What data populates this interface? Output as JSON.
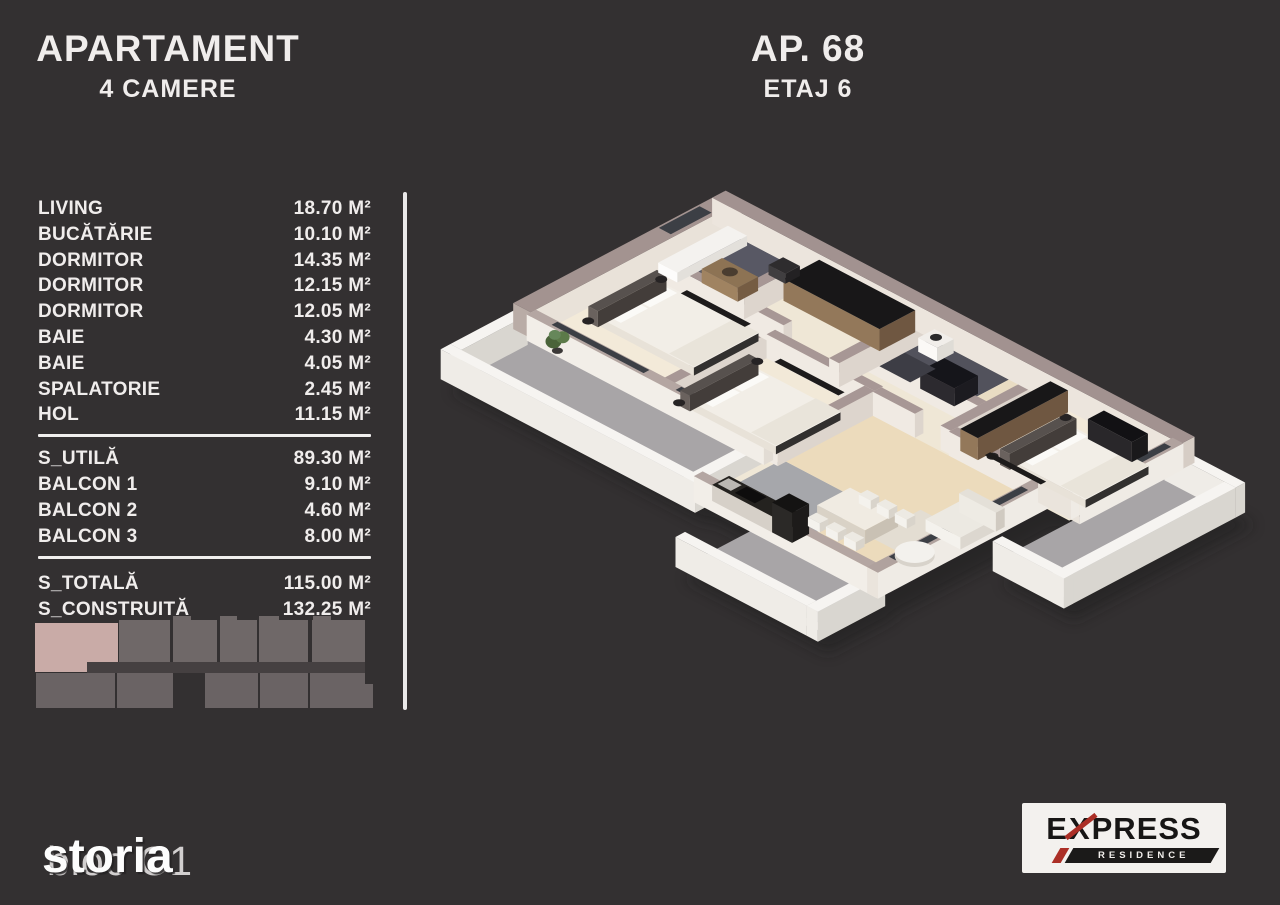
{
  "header_left": {
    "title": "APARTAMENT",
    "subtitle": "4 CAMERE"
  },
  "header_right": {
    "apartment": "AP. 68",
    "floor": "ETAJ 6"
  },
  "rooms": [
    {
      "name": "LIVING",
      "area": "18.70 M²"
    },
    {
      "name": "BUCĂTĂRIE",
      "area": "10.10 M²"
    },
    {
      "name": "DORMITOR",
      "area": "14.35 M²"
    },
    {
      "name": "DORMITOR",
      "area": "12.15 M²"
    },
    {
      "name": "DORMITOR",
      "area": "12.05 M²"
    },
    {
      "name": "BAIE",
      "area": "4.30 M²"
    },
    {
      "name": "BAIE",
      "area": "4.05 M²"
    },
    {
      "name": "SPALATORIE",
      "area": "2.45 M²"
    },
    {
      "name": "HOL",
      "area": "11.15 M²"
    }
  ],
  "summary": [
    {
      "name": "S_UTILĂ",
      "area": "89.30 M²"
    },
    {
      "name": "BALCON 1",
      "area": "9.10 M²"
    },
    {
      "name": "BALCON 2",
      "area": "4.60 M²"
    },
    {
      "name": "BALCON 3",
      "area": "8.00 M²"
    }
  ],
  "totals": [
    {
      "name": "S_TOTALĂ",
      "area": "115.00 M²"
    },
    {
      "name": "S_CONSTRUITĂ",
      "area": "132.25 M²"
    }
  ],
  "watermark": {
    "building": "bloc C1",
    "overlay": "storia"
  },
  "logo": {
    "brand_e": "E",
    "brand_x": "X",
    "brand_rest": "PRESS",
    "subtitle": "RESIDENCE"
  },
  "floor_plan": {
    "description": "3D isometric floor plan of 4-room apartment with 3 balconies"
  },
  "colors": {
    "background": "#333031",
    "text": "#f0edec",
    "divider": "#eae8e8",
    "minimap_block": "#6f6868",
    "minimap_highlight": "#c9aba7",
    "logo_red": "#ab2f26",
    "logo_black": "#171615",
    "plan_wall": "#a39390",
    "plan_floor": "#efe7d6",
    "plan_balcony": "#a8a5a7"
  }
}
